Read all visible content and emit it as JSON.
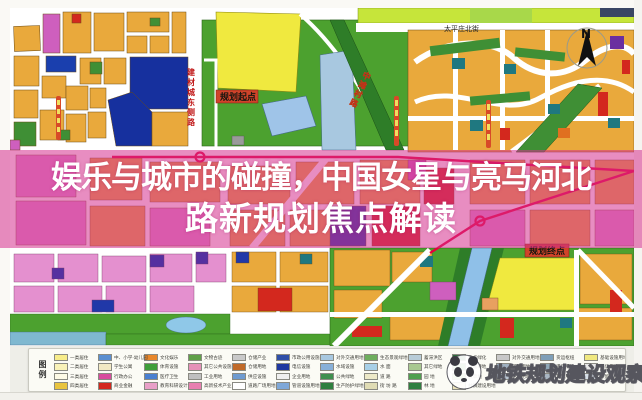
{
  "banner": {
    "line1": "娱乐与城市的碰撞，中国女星与亮马河北",
    "line2": "路新规划焦点解读"
  },
  "map": {
    "north_label": "N",
    "street_top": "太平庄北街",
    "road_east_side": "建材城东侧路",
    "road_zhongtan": "中滩村路",
    "start_label": "规划起点",
    "end_label": "规划终点"
  },
  "watermark": {
    "text": "地铁规划建设观察"
  },
  "legend": {
    "title": "图例",
    "columns": [
      {
        "items": [
          {
            "label": "一类居住",
            "color": "#f7ec8a"
          },
          {
            "label": "二类居住",
            "color": "#f9f2b8"
          },
          {
            "label": "三类居住",
            "color": "#fdfae6"
          },
          {
            "label": "四类居住",
            "color": "#e9c43f"
          }
        ]
      },
      {
        "items": [
          {
            "label": "中、小学·幼儿园",
            "color": "#5b8fd0"
          },
          {
            "label": "学生公寓",
            "color": "#f2e9c4"
          },
          {
            "label": "行政办公",
            "color": "#d84b9e"
          },
          {
            "label": "商业金融",
            "color": "#d3281e"
          }
        ]
      },
      {
        "items": [
          {
            "label": "文化娱乐",
            "color": "#e8872a"
          },
          {
            "label": "体育设施",
            "color": "#3f9e3a"
          },
          {
            "label": "医疗卫生",
            "color": "#4a7fd0"
          },
          {
            "label": "教育科研设计",
            "color": "#e9a0c8"
          }
        ]
      },
      {
        "items": [
          {
            "label": "文物古迹",
            "color": "#5fa049"
          },
          {
            "label": "其它公共设施",
            "color": "#e590b8"
          },
          {
            "label": "工业用地",
            "color": "#bfbfbf"
          },
          {
            "label": "高新技术产业",
            "color": "#e87fb0"
          }
        ]
      },
      {
        "items": [
          {
            "label": "仓储产业",
            "color": "#c9c9c9"
          },
          {
            "label": "仓储用地",
            "color": "#c06a28"
          },
          {
            "label": "供应设施",
            "color": "#6f9bd0"
          },
          {
            "label": "道路广场用地",
            "color": "#ffffff"
          }
        ]
      },
      {
        "items": [
          {
            "label": "市政公用设施",
            "color": "#2f4fa8"
          },
          {
            "label": "电信设施",
            "color": "#2038a0"
          },
          {
            "label": "企业用地",
            "color": "#efefef"
          },
          {
            "label": "管道设施用地",
            "color": "#7fa8d8"
          }
        ]
      },
      {
        "items": [
          {
            "label": "对外交通用地",
            "color": "#a8c8e0"
          },
          {
            "label": "水域设施",
            "color": "#88b0d8"
          },
          {
            "label": "公共绿地",
            "color": "#3f8f4f"
          },
          {
            "label": "生产防护绿地",
            "color": "#2f7f3f"
          }
        ]
      },
      {
        "items": [
          {
            "label": "生态景观绿地",
            "color": "#6faf5f"
          },
          {
            "label": "水  面",
            "color": "#a8d0e8"
          },
          {
            "label": "道  路",
            "color": "#ede9c8"
          },
          {
            "label": "街  坊  路",
            "color": "#e0dcb4"
          }
        ]
      },
      {
        "items": [
          {
            "label": "蓄滞洪区",
            "color": "#b8ccd8"
          },
          {
            "label": "其它绿地",
            "color": "#a8c890"
          },
          {
            "label": "园  地",
            "color": "#4f9f4f"
          },
          {
            "label": "林  地",
            "color": "#2f7f3f"
          }
        ]
      },
      {
        "items": [
          {
            "label": "重点绿化",
            "color": "#2f6f3f"
          },
          {
            "label": "一般耕地",
            "color": "#5fa05f"
          },
          {
            "label": "牧草地",
            "color": "#8fbf6f"
          },
          {
            "label": "村镇建设用地",
            "color": "#e8e0b8"
          }
        ]
      },
      {
        "items": [
          {
            "label": "对外交通用地",
            "color": "#c8c8c8"
          },
          {
            "label": "铁路用地",
            "color": "#9fb0c0"
          },
          {
            "label": "站场用地",
            "color": "#b8c4d0"
          }
        ]
      },
      {
        "items": [
          {
            "label": "货运枢纽",
            "color": "#7f9fb8"
          },
          {
            "label": "港口用地",
            "color": "#8fa8b8"
          },
          {
            "label": "其它用地",
            "color": "#a9b6c2"
          }
        ]
      },
      {
        "items": [
          {
            "label": "基础设施用地",
            "color": "#f0e87f"
          },
          {
            "label": "电信用地",
            "color": "#e8e8e8"
          },
          {
            "label": "保留用地",
            "color": "#d8e0e8"
          }
        ]
      }
    ]
  }
}
